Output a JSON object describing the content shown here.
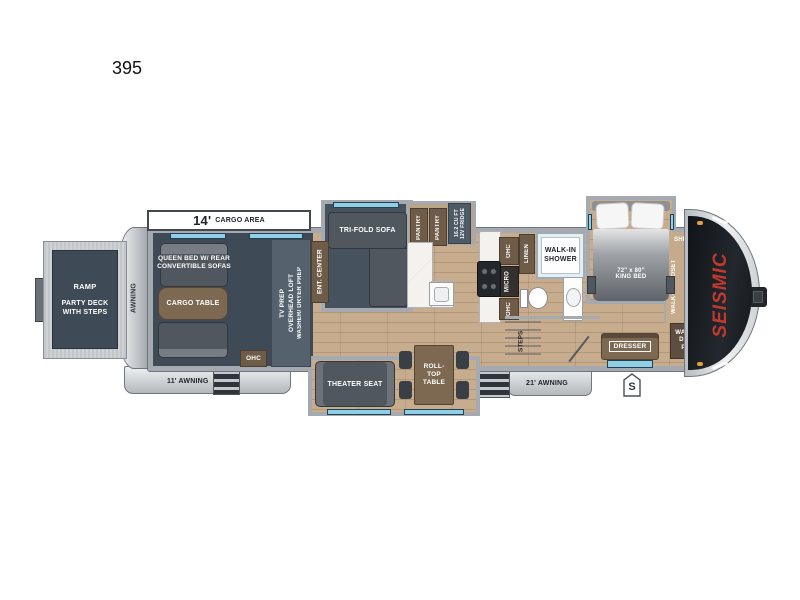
{
  "model": {
    "number": "395",
    "brand": "SEISMIC"
  },
  "colors": {
    "accent_red": "#c0392e",
    "garage_floor": "#3e4a56",
    "wood_floor": "#c8ac8e",
    "cabinet_brown": "#6e5b48",
    "window_blue": "#8fd0e8",
    "wall_gray": "#a5aab0"
  },
  "exterior": {
    "cargo_area_length": "14'",
    "cargo_area_label": "CARGO AREA",
    "rear_awning": "AWNING",
    "awning_left": "11' AWNING",
    "awning_right": "21' AWNING",
    "s_marker": "S"
  },
  "garage": {
    "ramp": "RAMP",
    "party_deck": "PARTY DECK WITH STEPS",
    "queen_bed": "QUEEN BED W/ REAR CONVERTIBLE SOFAS",
    "cargo_table": "CARGO TABLE",
    "ohc": "OHC",
    "tv_prep": "TV PREP",
    "overhead_loft": "OVERHEAD LOFT",
    "washer_dryer_prep": "WASHER/ DRYER PREP"
  },
  "living": {
    "ent_center": "ENT. CENTER",
    "tri_fold_sofa": "TRI-FOLD SOFA",
    "theater_seat": "THEATER SEAT",
    "roll_top_table": "ROLL-TOP TABLE"
  },
  "kitchen": {
    "pantry": "PANTRY",
    "fridge_line1": "16.2 CU FT",
    "fridge_line2": "12V FRIDGE",
    "ohc": "OHC",
    "micro": "MICRO"
  },
  "bath": {
    "linen": "LINEN",
    "walk_in_shower": "WALK-IN SHOWER",
    "steps": "STEPS"
  },
  "bedroom": {
    "king_bed_size": "72\" x 80\"",
    "king_bed": "KING BED",
    "shelves": "SHELVES",
    "walk_in_closet": "WALK-IN CLOSET",
    "washer_dryer_prep": "WASHER/ DRYER PREP",
    "dresser": "DRESSER"
  }
}
